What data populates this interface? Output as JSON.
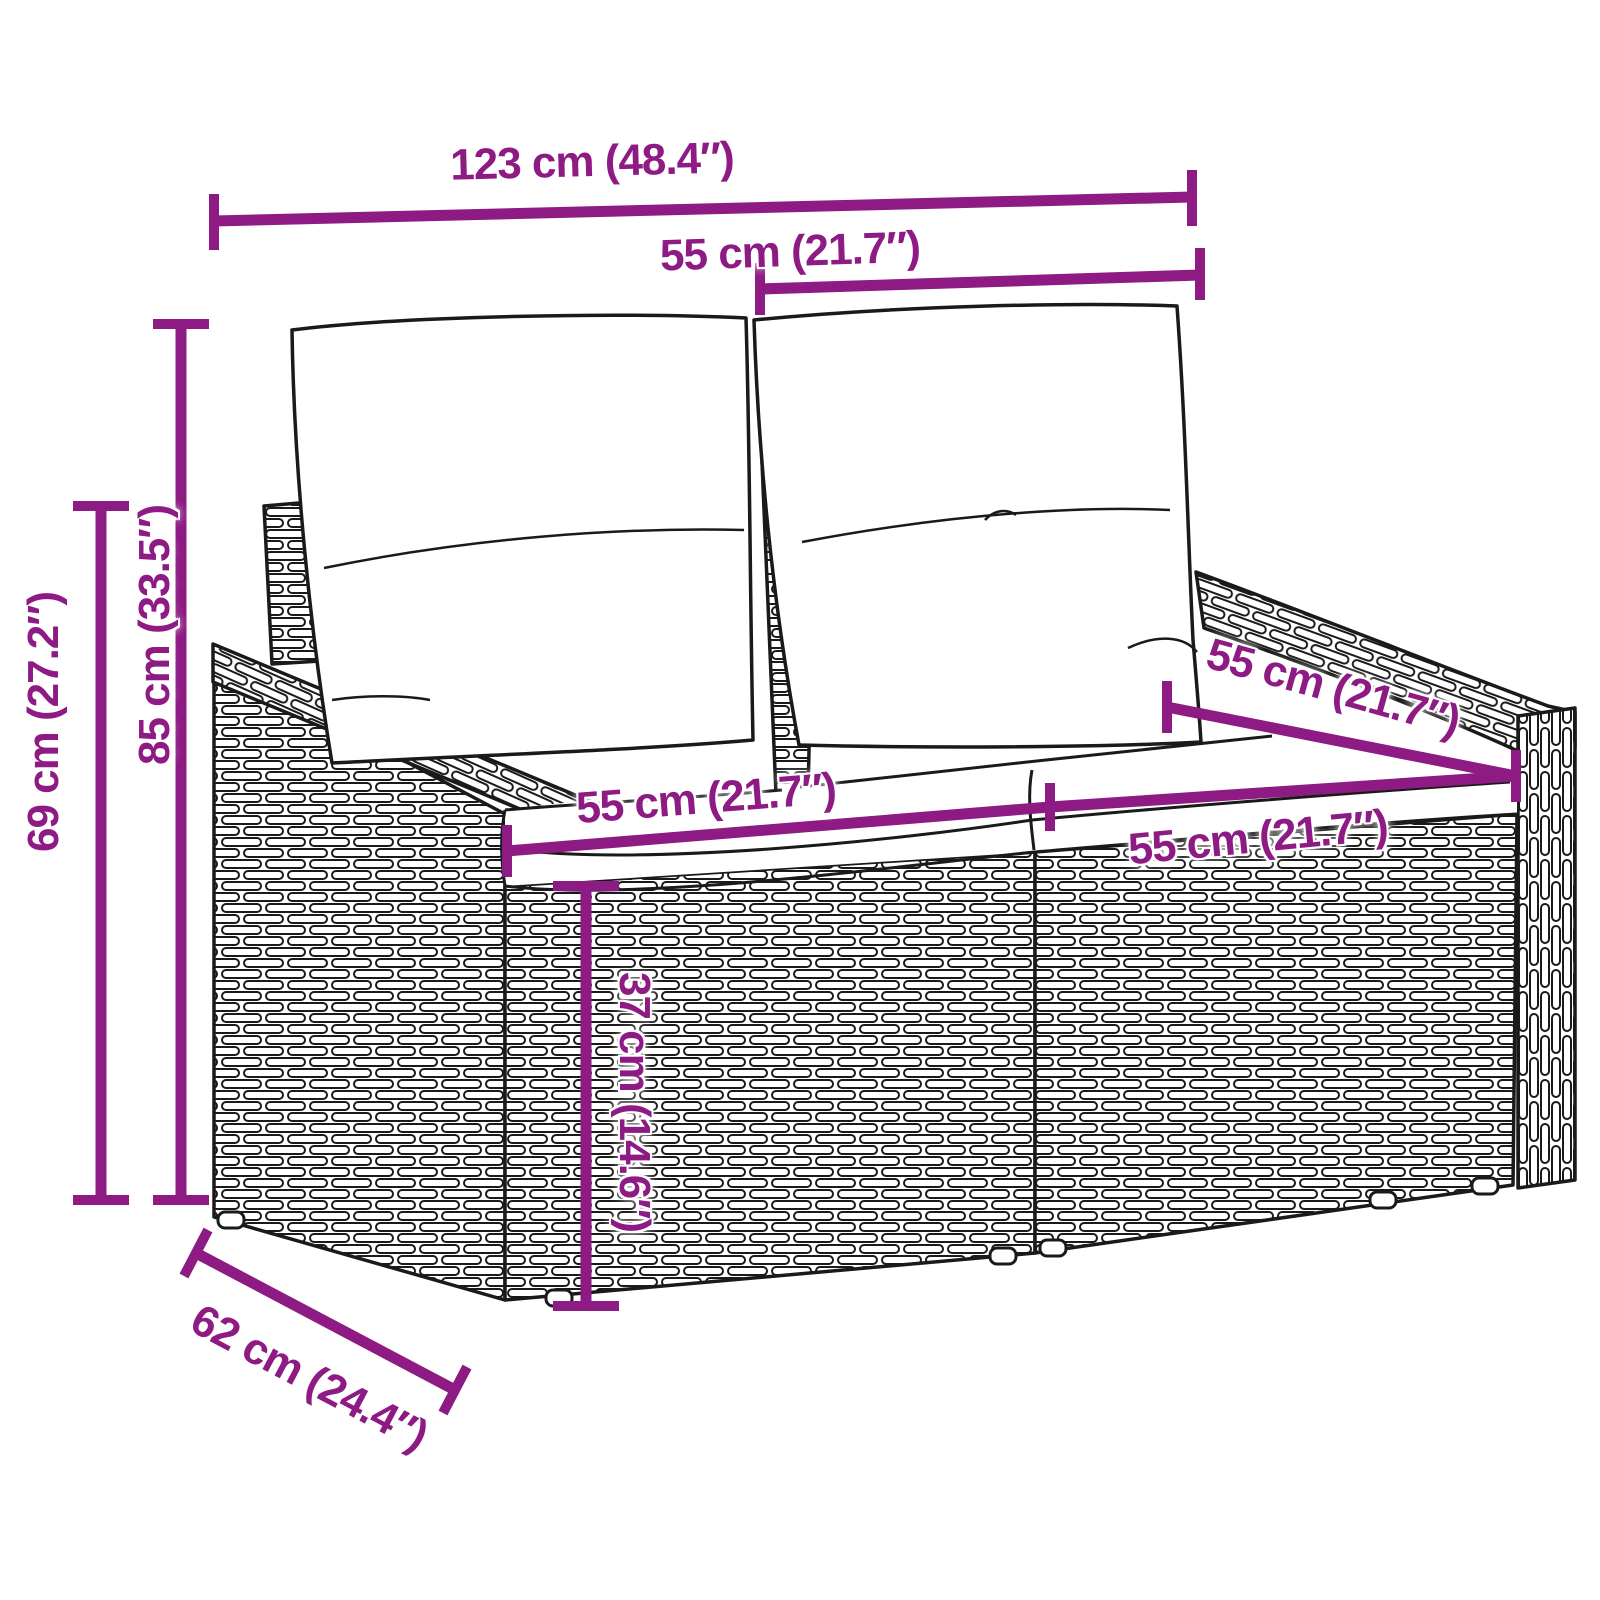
{
  "colors": {
    "dimension_accent": "#8e1a84",
    "line_art": "#1a1a1a",
    "background": "#ffffff"
  },
  "dims": {
    "overall_width": "123 cm (48.4″)",
    "back_cushion_width": "55 cm (21.7″)",
    "total_height": "85 cm (33.5″)",
    "back_height": "69 cm (27.2″)",
    "seat_width_left": "55 cm (21.7″)",
    "seat_width_right": "55 cm (21.7″)",
    "seat_depth": "55 cm (21.7″)",
    "seat_height": "37 cm (14.6″)",
    "overall_depth": "62 cm (24.4″)"
  }
}
